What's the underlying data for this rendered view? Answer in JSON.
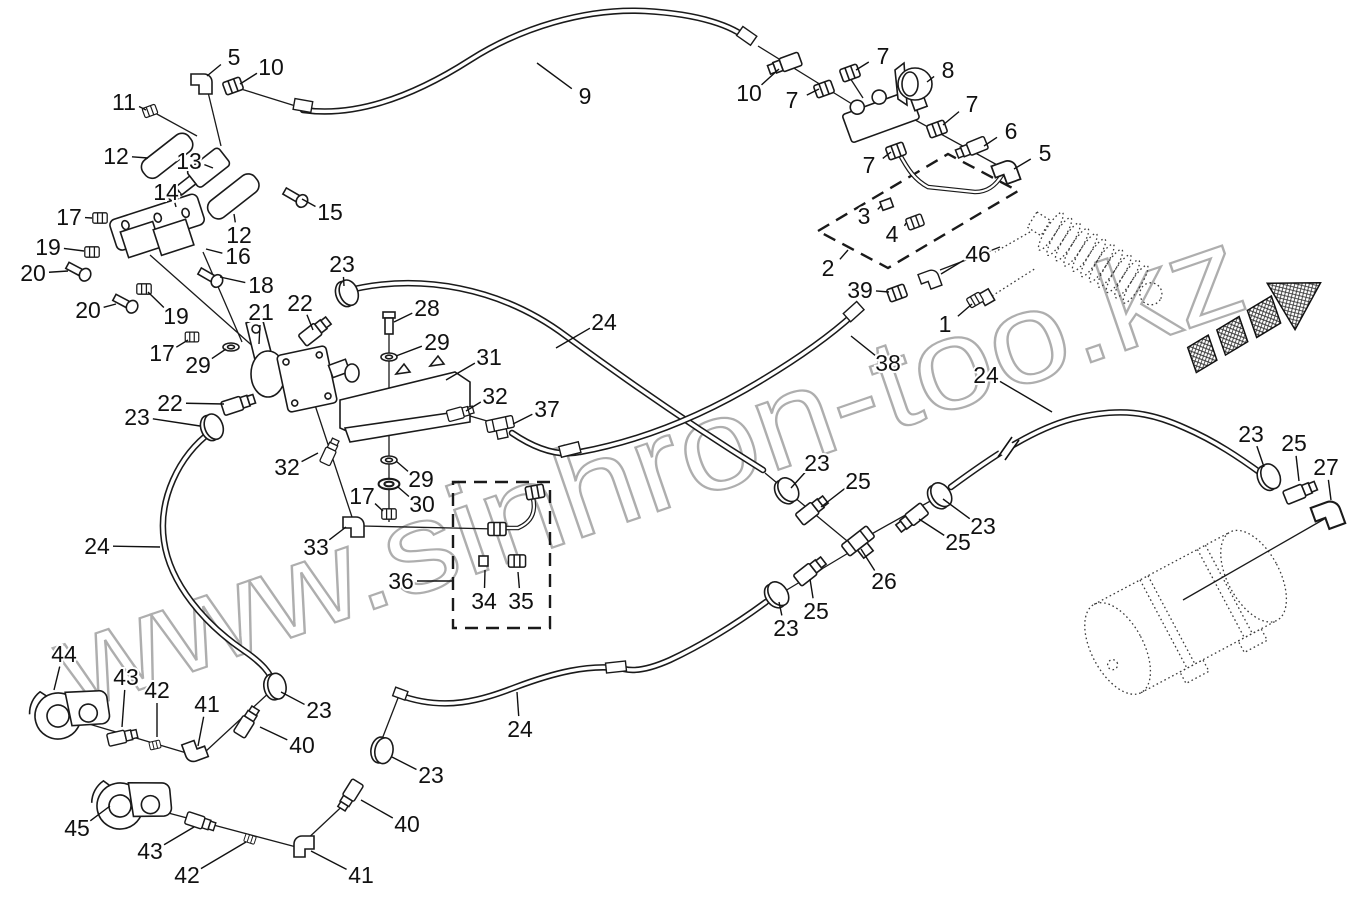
{
  "watermark": {
    "text": "www.sinhron-too.kz"
  },
  "diagram_type": "exploded-parts-diagram",
  "callouts": [
    {
      "n": "5",
      "x": 234,
      "y": 57,
      "tx": 207,
      "ty": 76
    },
    {
      "n": "10",
      "x": 271,
      "y": 67,
      "tx": 240,
      "ty": 84
    },
    {
      "n": "11",
      "x": 124,
      "y": 102,
      "tx": 146,
      "ty": 110
    },
    {
      "n": "12",
      "x": 116,
      "y": 156,
      "tx": 148,
      "ty": 158
    },
    {
      "n": "13",
      "x": 189,
      "y": 161,
      "tx": 213,
      "ty": 168
    },
    {
      "n": "14",
      "x": 166,
      "y": 192,
      "tx": 176,
      "ty": 207
    },
    {
      "n": "15",
      "x": 330,
      "y": 212,
      "tx": 302,
      "ty": 199
    },
    {
      "n": "17",
      "x": 69,
      "y": 217,
      "tx": 92,
      "ty": 218
    },
    {
      "n": "12",
      "x": 239,
      "y": 235,
      "tx": 234,
      "ty": 214
    },
    {
      "n": "16",
      "x": 238,
      "y": 256,
      "tx": 206,
      "ty": 249
    },
    {
      "n": "19",
      "x": 48,
      "y": 247,
      "tx": 84,
      "ty": 251
    },
    {
      "n": "20",
      "x": 33,
      "y": 273,
      "tx": 68,
      "ty": 271
    },
    {
      "n": "20",
      "x": 88,
      "y": 310,
      "tx": 116,
      "ty": 304
    },
    {
      "n": "19",
      "x": 176,
      "y": 316,
      "tx": 148,
      "ty": 292
    },
    {
      "n": "18",
      "x": 261,
      "y": 285,
      "tx": 220,
      "ty": 277
    },
    {
      "n": "17",
      "x": 162,
      "y": 353,
      "tx": 188,
      "ty": 340
    },
    {
      "n": "29",
      "x": 198,
      "y": 365,
      "tx": 226,
      "ty": 349
    },
    {
      "n": "21",
      "x": 261,
      "y": 312,
      "tx": 259,
      "ty": 344
    },
    {
      "n": "22",
      "x": 300,
      "y": 303,
      "tx": 313,
      "ty": 330
    },
    {
      "n": "23",
      "x": 342,
      "y": 264,
      "tx": 344,
      "ty": 286
    },
    {
      "n": "28",
      "x": 427,
      "y": 308,
      "tx": 394,
      "ty": 322
    },
    {
      "n": "29",
      "x": 437,
      "y": 342,
      "tx": 396,
      "ty": 356
    },
    {
      "n": "31",
      "x": 489,
      "y": 357,
      "tx": 446,
      "ty": 380
    },
    {
      "n": "32",
      "x": 495,
      "y": 396,
      "tx": 466,
      "ty": 411
    },
    {
      "n": "37",
      "x": 547,
      "y": 409,
      "tx": 513,
      "ty": 424
    },
    {
      "n": "24",
      "x": 604,
      "y": 322,
      "tx": 556,
      "ty": 348
    },
    {
      "n": "22",
      "x": 170,
      "y": 403,
      "tx": 224,
      "ty": 404
    },
    {
      "n": "23",
      "x": 137,
      "y": 417,
      "tx": 200,
      "ty": 426
    },
    {
      "n": "32",
      "x": 287,
      "y": 467,
      "tx": 318,
      "ty": 453
    },
    {
      "n": "29",
      "x": 421,
      "y": 479,
      "tx": 396,
      "ty": 461
    },
    {
      "n": "30",
      "x": 422,
      "y": 504,
      "tx": 398,
      "ty": 487
    },
    {
      "n": "17",
      "x": 362,
      "y": 496,
      "tx": 383,
      "ty": 511
    },
    {
      "n": "33",
      "x": 316,
      "y": 547,
      "tx": 346,
      "ty": 527
    },
    {
      "n": "36",
      "x": 401,
      "y": 581,
      "tx": 452,
      "ty": 581
    },
    {
      "n": "34",
      "x": 484,
      "y": 601,
      "tx": 485,
      "ty": 570
    },
    {
      "n": "35",
      "x": 521,
      "y": 601,
      "tx": 518,
      "ty": 572
    },
    {
      "n": "24",
      "x": 97,
      "y": 546,
      "tx": 160,
      "ty": 547
    },
    {
      "n": "23",
      "x": 319,
      "y": 710,
      "tx": 281,
      "ty": 692
    },
    {
      "n": "40",
      "x": 302,
      "y": 745,
      "tx": 260,
      "ty": 727
    },
    {
      "n": "44",
      "x": 64,
      "y": 654,
      "tx": 54,
      "ty": 690
    },
    {
      "n": "43",
      "x": 126,
      "y": 677,
      "tx": 122,
      "ty": 727
    },
    {
      "n": "42",
      "x": 157,
      "y": 690,
      "tx": 157,
      "ty": 737
    },
    {
      "n": "41",
      "x": 207,
      "y": 704,
      "tx": 198,
      "ty": 746
    },
    {
      "n": "45",
      "x": 77,
      "y": 828,
      "tx": 110,
      "ty": 806
    },
    {
      "n": "43",
      "x": 150,
      "y": 851,
      "tx": 194,
      "ty": 827
    },
    {
      "n": "42",
      "x": 187,
      "y": 875,
      "tx": 246,
      "ty": 842
    },
    {
      "n": "41",
      "x": 361,
      "y": 875,
      "tx": 311,
      "ty": 851
    },
    {
      "n": "23",
      "x": 431,
      "y": 775,
      "tx": 392,
      "ty": 757
    },
    {
      "n": "40",
      "x": 407,
      "y": 824,
      "tx": 361,
      "ty": 800
    },
    {
      "n": "24",
      "x": 520,
      "y": 729,
      "tx": 517,
      "ty": 692
    },
    {
      "n": "23",
      "x": 817,
      "y": 463,
      "tx": 791,
      "ty": 488
    },
    {
      "n": "25",
      "x": 858,
      "y": 481,
      "tx": 821,
      "ty": 507
    },
    {
      "n": "26",
      "x": 884,
      "y": 581,
      "tx": 861,
      "ty": 549
    },
    {
      "n": "25",
      "x": 958,
      "y": 542,
      "tx": 919,
      "ty": 519
    },
    {
      "n": "23",
      "x": 983,
      "y": 526,
      "tx": 943,
      "ty": 499
    },
    {
      "n": "25",
      "x": 816,
      "y": 611,
      "tx": 810,
      "ty": 579
    },
    {
      "n": "23",
      "x": 786,
      "y": 628,
      "tx": 779,
      "ty": 602
    },
    {
      "n": "24",
      "x": 986,
      "y": 375,
      "tx": 1052,
      "ty": 412
    },
    {
      "n": "38",
      "x": 888,
      "y": 363,
      "tx": 851,
      "ty": 336
    },
    {
      "n": "39",
      "x": 860,
      "y": 290,
      "tx": 889,
      "ty": 292
    },
    {
      "n": "46",
      "x": 978,
      "y": 254,
      "tx": 941,
      "ty": 274
    },
    {
      "n": "1",
      "x": 945,
      "y": 324,
      "tx": 972,
      "ty": 304
    },
    {
      "n": "2",
      "x": 828,
      "y": 268,
      "tx": 848,
      "ty": 250
    },
    {
      "n": "3",
      "x": 864,
      "y": 216,
      "tx": 881,
      "ty": 206
    },
    {
      "n": "4",
      "x": 892,
      "y": 234,
      "tx": 906,
      "ty": 223
    },
    {
      "n": "5",
      "x": 1045,
      "y": 153,
      "tx": 1014,
      "ty": 169
    },
    {
      "n": "6",
      "x": 1011,
      "y": 131,
      "tx": 984,
      "ty": 146
    },
    {
      "n": "7",
      "x": 972,
      "y": 104,
      "tx": 943,
      "ty": 125
    },
    {
      "n": "8",
      "x": 948,
      "y": 70,
      "tx": 927,
      "ty": 82
    },
    {
      "n": "7",
      "x": 883,
      "y": 56,
      "tx": 856,
      "ty": 70
    },
    {
      "n": "7",
      "x": 792,
      "y": 100,
      "tx": 819,
      "ty": 89
    },
    {
      "n": "10",
      "x": 749,
      "y": 93,
      "tx": 779,
      "ty": 69
    },
    {
      "n": "7",
      "x": 869,
      "y": 165,
      "tx": 891,
      "ty": 152
    },
    {
      "n": "9",
      "x": 585,
      "y": 96,
      "tx": 537,
      "ty": 63
    },
    {
      "n": "23",
      "x": 1251,
      "y": 434,
      "tx": 1264,
      "ty": 467
    },
    {
      "n": "25",
      "x": 1294,
      "y": 443,
      "tx": 1299,
      "ty": 481
    },
    {
      "n": "27",
      "x": 1326,
      "y": 467,
      "tx": 1331,
      "ty": 500
    }
  ]
}
